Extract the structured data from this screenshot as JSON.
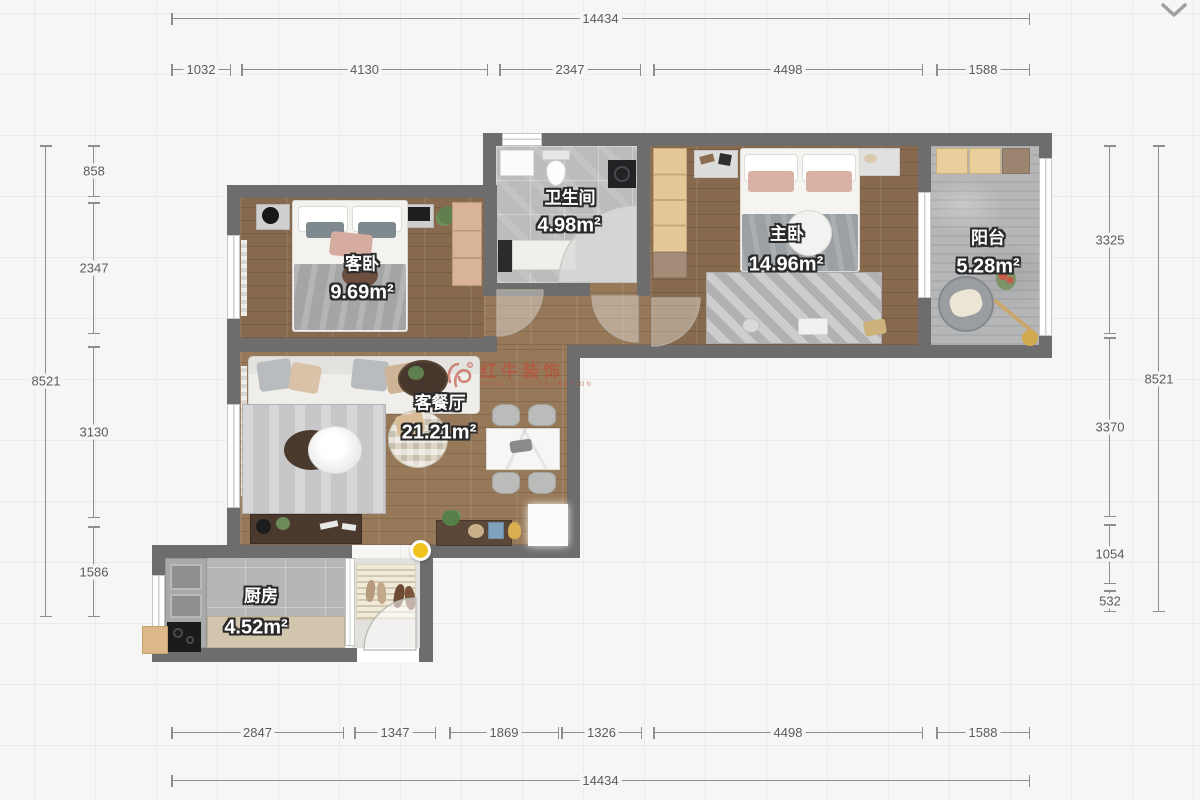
{
  "header": {
    "collapse_icon": "chevron-down-icon"
  },
  "floorplan": {
    "rooms": [
      {
        "name": "客卧",
        "area": "9.69m²"
      },
      {
        "name": "卫生间",
        "area": "4.98m²"
      },
      {
        "name": "主卧",
        "area": "14.96m²"
      },
      {
        "name": "阳台",
        "area": "5.28m²"
      },
      {
        "name": "客餐厅",
        "area": "21.21m²"
      },
      {
        "name": "厨房",
        "area": "4.52m²"
      }
    ],
    "watermark": {
      "title": "红牛装饰",
      "subtitle": "HONG NIU DECORATION",
      "color": "#bd4b36"
    },
    "marker_color": "#f3c31d"
  },
  "dimensions": {
    "top_total": "14434",
    "top_row": [
      "1032",
      "4130",
      "2347",
      "4498",
      "1588"
    ],
    "left_total": "8521",
    "left_row": [
      "858",
      "2347",
      "3130",
      "1586"
    ],
    "right_row": [
      "3325",
      "3370",
      "1054",
      "532"
    ],
    "right_total": "8521",
    "bottom_row": [
      "2847",
      "1347",
      "1869",
      "1326",
      "4498",
      "1588"
    ],
    "bottom_total": "14434"
  },
  "colors": {
    "wall": "#6d6d6d",
    "wood": "#876a4d",
    "tile": "#bcbcbc",
    "dimension": "#8e8e8e"
  }
}
